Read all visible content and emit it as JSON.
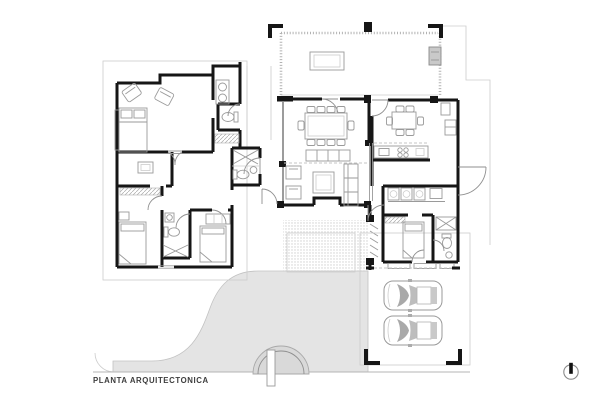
{
  "document": {
    "title": "PLANTA ARQUITECTONICA"
  },
  "north_indicator": {
    "icon": "north-symbol",
    "position": "bottom-right"
  },
  "colors": {
    "wall": "#161616",
    "line": "#9a9a9a",
    "line_light": "#cccccc",
    "paving": "#e4e4e4",
    "paving_dark": "#d9d9d9",
    "text": "#3d3d3d",
    "bg": "#ffffff"
  },
  "plan": {
    "type": "architectural-floor-plan",
    "rooms_depicted": [
      "open-terrace",
      "dining-room",
      "living-room",
      "kitchen",
      "master-bedroom",
      "master-bathroom",
      "dressing-room",
      "bedroom-2",
      "bedroom-3",
      "bathroom",
      "powder-room",
      "entry-hall",
      "entry-courtyard",
      "laundry-room",
      "service-bedroom",
      "service-bathroom",
      "garage",
      "driveway"
    ],
    "vehicles_depicted": 2,
    "dining_seats_depicted": 10,
    "breakfast_seats_depicted": 6
  }
}
